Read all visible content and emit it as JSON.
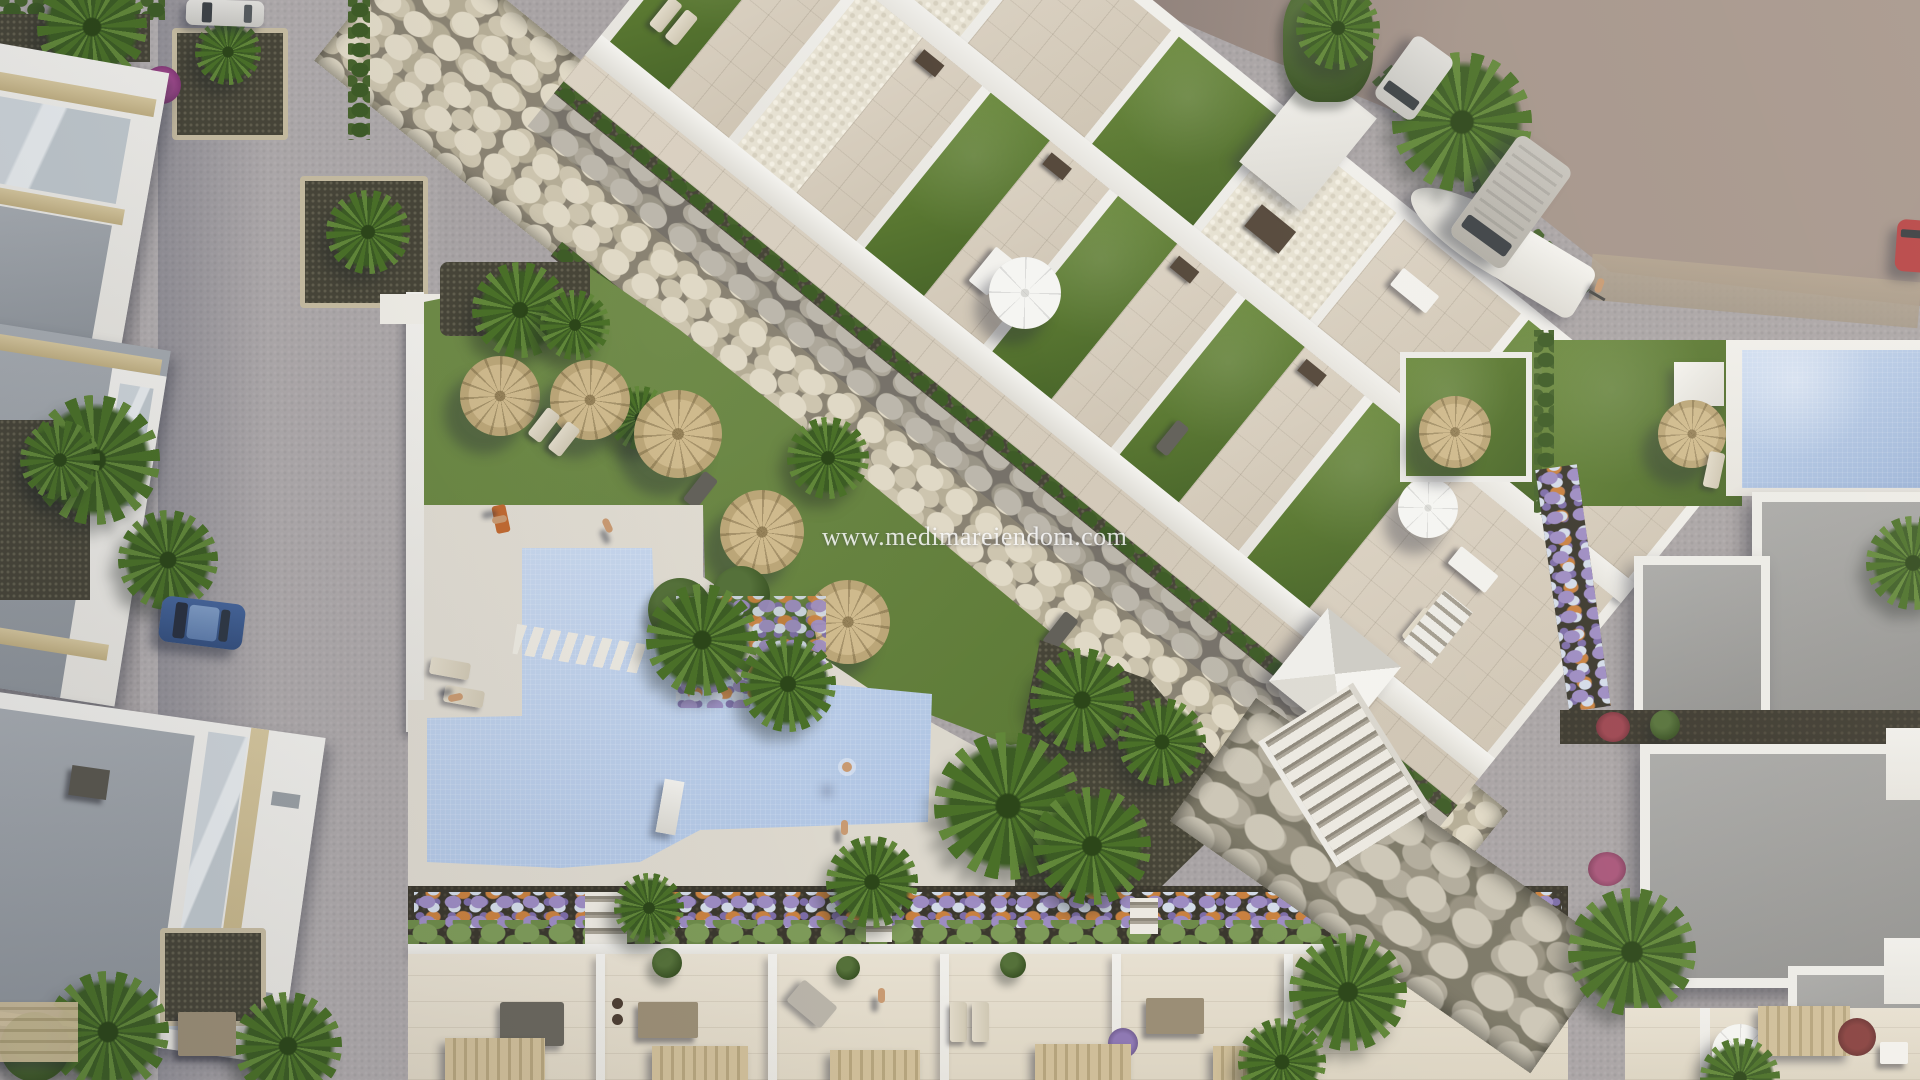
{
  "scene": {
    "type": "aerial-architectural-render",
    "watermark": "www.medimareiendom.com",
    "description": "Top-down 3D render of a residential resort: diagonal apartment block with private lawns and terraces, dry stone river, communal lawn with straw parasols, angled swimming pool, rows of townhouses, streets with parked cars and vans"
  },
  "palette": {
    "plaza": "#a9a4a5",
    "dirt": "#8f817b",
    "lawn": "#5d7b33",
    "pool_water": "#b2c7e5",
    "deck": "#dcd8cd",
    "white_wall": "#efeeea",
    "terrace_tile": "#d8cfc0",
    "river_stones": "#cfc8b4",
    "dark_gravel": "#474538",
    "hedge_green": "#3e5c27",
    "palm_green": "#4a7028",
    "straw_parasol": "#c7b183",
    "roof_gray": "#9a9ea3",
    "beige_trim": "#cbbb92",
    "car_blue": "#3f5e8c",
    "car_red": "#b54041",
    "van_gray": "#bcb9b1",
    "van_white": "#d8d7d3"
  }
}
